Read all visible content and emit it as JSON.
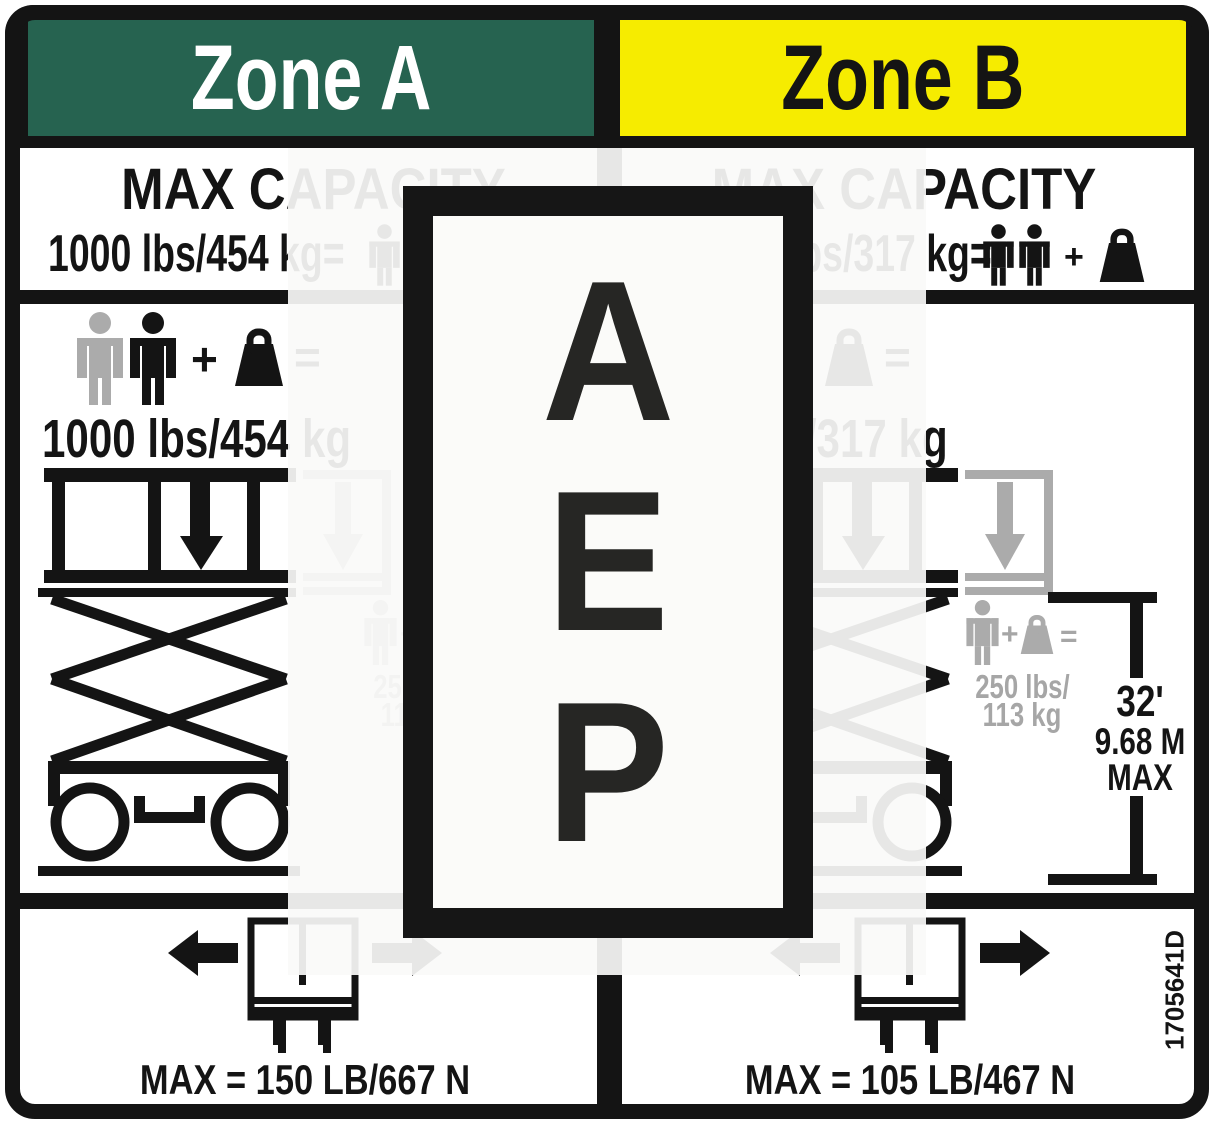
{
  "part_number": "1705641D",
  "symbols": {
    "plus": "+",
    "equals": "="
  },
  "watermark": {
    "letters": [
      "A",
      "E",
      "P"
    ]
  },
  "colors": {
    "zone_a_green": "#266350",
    "zone_b_yellow": "#F6EC00",
    "ink": "#141414",
    "gray": "#ABABAB",
    "gray_text": "#A6A6A6"
  },
  "zone_a": {
    "title": "Zone A",
    "heading": "MAX CAPACITY",
    "capacity_line": "1000 lbs/454 kg=",
    "capacity_big": "1000 lbs/454 kg",
    "ext_capacity_lbs": "250 lbs/",
    "ext_capacity_kg": "113 kg",
    "deck_max": "MAX = 150 LB/667 N"
  },
  "zone_b": {
    "title": "Zone B",
    "heading": "MAX CAPACITY",
    "capacity_line": "700 lbs/317 kg=",
    "capacity_big": "700 lbs/317 kg",
    "ext_capacity_lbs": "250 lbs/",
    "ext_capacity_kg": "113 kg",
    "height_ft": "32'",
    "height_m": "9.68 M",
    "height_max": "MAX",
    "deck_max": "MAX = 105 LB/467 N"
  }
}
